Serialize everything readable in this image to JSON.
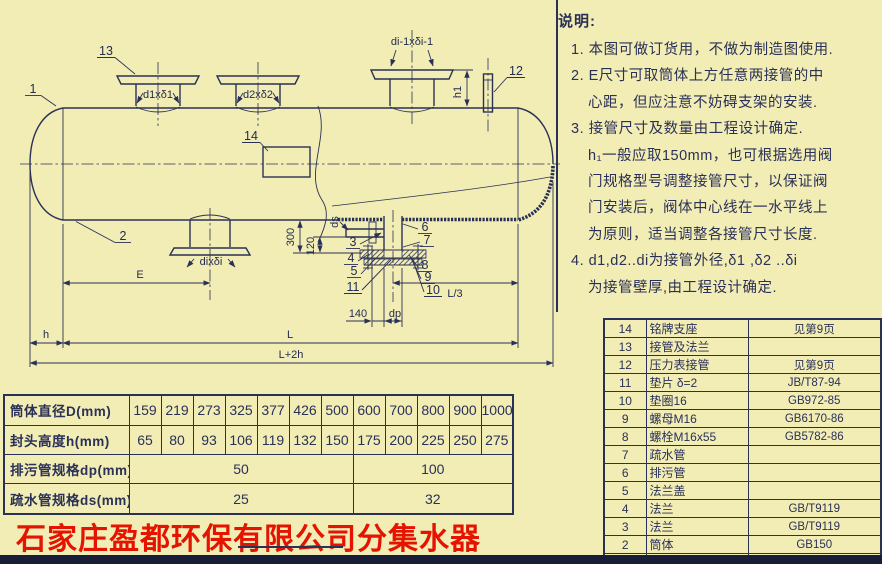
{
  "colors": {
    "paper": "#f2ecb5",
    "ink": "#2a3157",
    "red": "#e51400",
    "strip": "#181d38"
  },
  "company_title": "石家庄盈都环保有限公司分集水器",
  "notes": {
    "title": "说明:",
    "lines": [
      {
        "text": "1. 本图可做订货用，不做为制造图使用."
      },
      {
        "text": "2. E尺寸可取筒体上方任意两接管的中"
      },
      {
        "text": "心距，但应注意不妨碍支架的安装."
      },
      {
        "text": "3. 接管尺寸及数量由工程设计确定."
      },
      {
        "text": "h₁一般应取150mm，也可根据选用阀"
      },
      {
        "text": "门规格型号调整接管尺寸，以保证阀"
      },
      {
        "text": "门安装后，阀体中心线在一水平线上"
      },
      {
        "text": "为原则，适当调整各接管尺寸长度."
      },
      {
        "text": "4. d1,d2..di为接管外径,δ1 ,δ2 ..δi"
      },
      {
        "text": "为接管壁厚,由工程设计确定."
      }
    ]
  },
  "parts_table": {
    "rows": [
      {
        "no": "14",
        "name": "铭牌支座",
        "remark": "见第9页"
      },
      {
        "no": "13",
        "name": "接管及法兰",
        "remark": ""
      },
      {
        "no": "12",
        "name": "压力表接管",
        "remark": "见第9页"
      },
      {
        "no": "11",
        "name": "垫片 δ=2",
        "remark": "JB/T87-94"
      },
      {
        "no": "10",
        "name": "垫圈16",
        "remark": "GB972-85"
      },
      {
        "no": "9",
        "name": "螺母M16",
        "remark": "GB6170-86"
      },
      {
        "no": "8",
        "name": "螺栓M16x55",
        "remark": "GB5782-86"
      },
      {
        "no": "7",
        "name": "疏水管",
        "remark": ""
      },
      {
        "no": "6",
        "name": "排污管",
        "remark": ""
      },
      {
        "no": "5",
        "name": "法兰盖",
        "remark": ""
      },
      {
        "no": "4",
        "name": "法兰",
        "remark": "GB/T9119"
      },
      {
        "no": "3",
        "name": "法兰",
        "remark": "GB/T9119"
      },
      {
        "no": "2",
        "name": "筒体",
        "remark": "GB150"
      },
      {
        "no": "1",
        "name": "封头",
        "remark": "JB/T4746"
      }
    ],
    "footer": {
      "no": "序号",
      "name": "名称及规格",
      "remark": "备注"
    }
  },
  "dim_table": {
    "row_labels": [
      "筒体直径D(mm)",
      "封头高度h(mm)",
      "排污管规格dp(mm)",
      "疏水管规格ds(mm)"
    ],
    "diameters": [
      "159",
      "219",
      "273",
      "325",
      "377",
      "426",
      "500",
      "600",
      "700",
      "800",
      "900",
      "1000"
    ],
    "head_heights": [
      "65",
      "80",
      "93",
      "106",
      "119",
      "132",
      "150",
      "175",
      "200",
      "225",
      "250",
      "275"
    ],
    "drain_spec": {
      "group1": "50",
      "group2": "100"
    },
    "trap_spec": {
      "group1": "25",
      "group2": "32"
    }
  },
  "drawing": {
    "labels": {
      "part_1": "1",
      "part_2": "2",
      "part_3": "3",
      "part_4": "4",
      "part_5": "5",
      "part_6": "6",
      "part_7": "7",
      "part_8": "8",
      "part_9": "9",
      "part_10": "10",
      "part_11": "11",
      "part_12": "12",
      "part_13": "13",
      "part_14": "14",
      "d1": "d1xδ1",
      "d2": "d2xδ2",
      "di_1": "di-1xδi-1",
      "di": "dixδi",
      "h1": "h1",
      "v300": "300",
      "v120": "120",
      "v140": "140",
      "dp": "dp",
      "ds": "ds",
      "L3": "L/3",
      "E": "E",
      "h": "h",
      "L": "L",
      "L2h": "L+2h"
    }
  }
}
